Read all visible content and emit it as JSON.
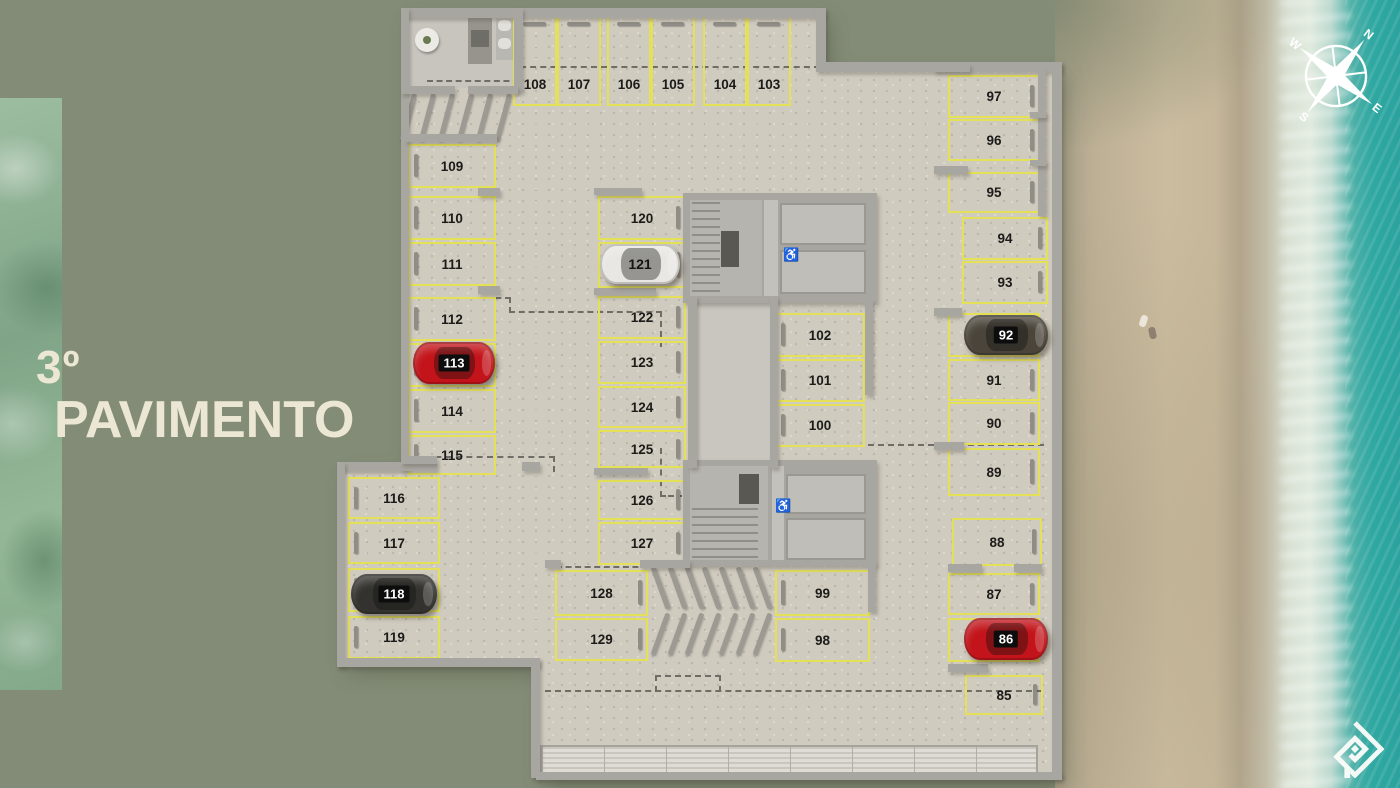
{
  "title": {
    "floor_number": "3º",
    "floor_name": "PAVIMENTO"
  },
  "compass": {
    "n": "N",
    "e": "E",
    "s": "S",
    "w": "W"
  },
  "floor_plan": {
    "spot_numbers": [
      "85",
      "86",
      "87",
      "88",
      "89",
      "90",
      "91",
      "92",
      "93",
      "94",
      "95",
      "96",
      "97",
      "98",
      "99",
      "100",
      "101",
      "102",
      "103",
      "104",
      "105",
      "106",
      "107",
      "108",
      "109",
      "110",
      "111",
      "112",
      "113",
      "114",
      "115",
      "116",
      "117",
      "118",
      "119",
      "120",
      "121",
      "122",
      "123",
      "124",
      "125",
      "126",
      "127",
      "128",
      "129"
    ],
    "occupied_spots": [
      {
        "spot": "86",
        "car_color": "#c2141a",
        "plate_style": "dark"
      },
      {
        "spot": "92",
        "car_color": "#4a443a",
        "plate_style": "dark"
      },
      {
        "spot": "113",
        "car_color": "#c2141a",
        "plate_style": "dark"
      },
      {
        "spot": "118",
        "car_color": "#33322e",
        "plate_style": "dark"
      },
      {
        "spot": "121",
        "car_color": "#e8e7e3",
        "plate_style": "light"
      }
    ],
    "accessible_icon": "♿"
  },
  "colors": {
    "background_olive": "#838c76",
    "title_cream": "#ece7d4",
    "stall_yellow": "#e4e057",
    "concrete": "#d0cbbf",
    "wall_gray": "#a8a6a0",
    "sand": "#c9ba9d",
    "ocean_teal": "#2fa8a2",
    "car_red": "#c2141a",
    "compass_white": "#ffffff"
  },
  "branding": {
    "logo_icon": "nested-diamond-monogram"
  }
}
